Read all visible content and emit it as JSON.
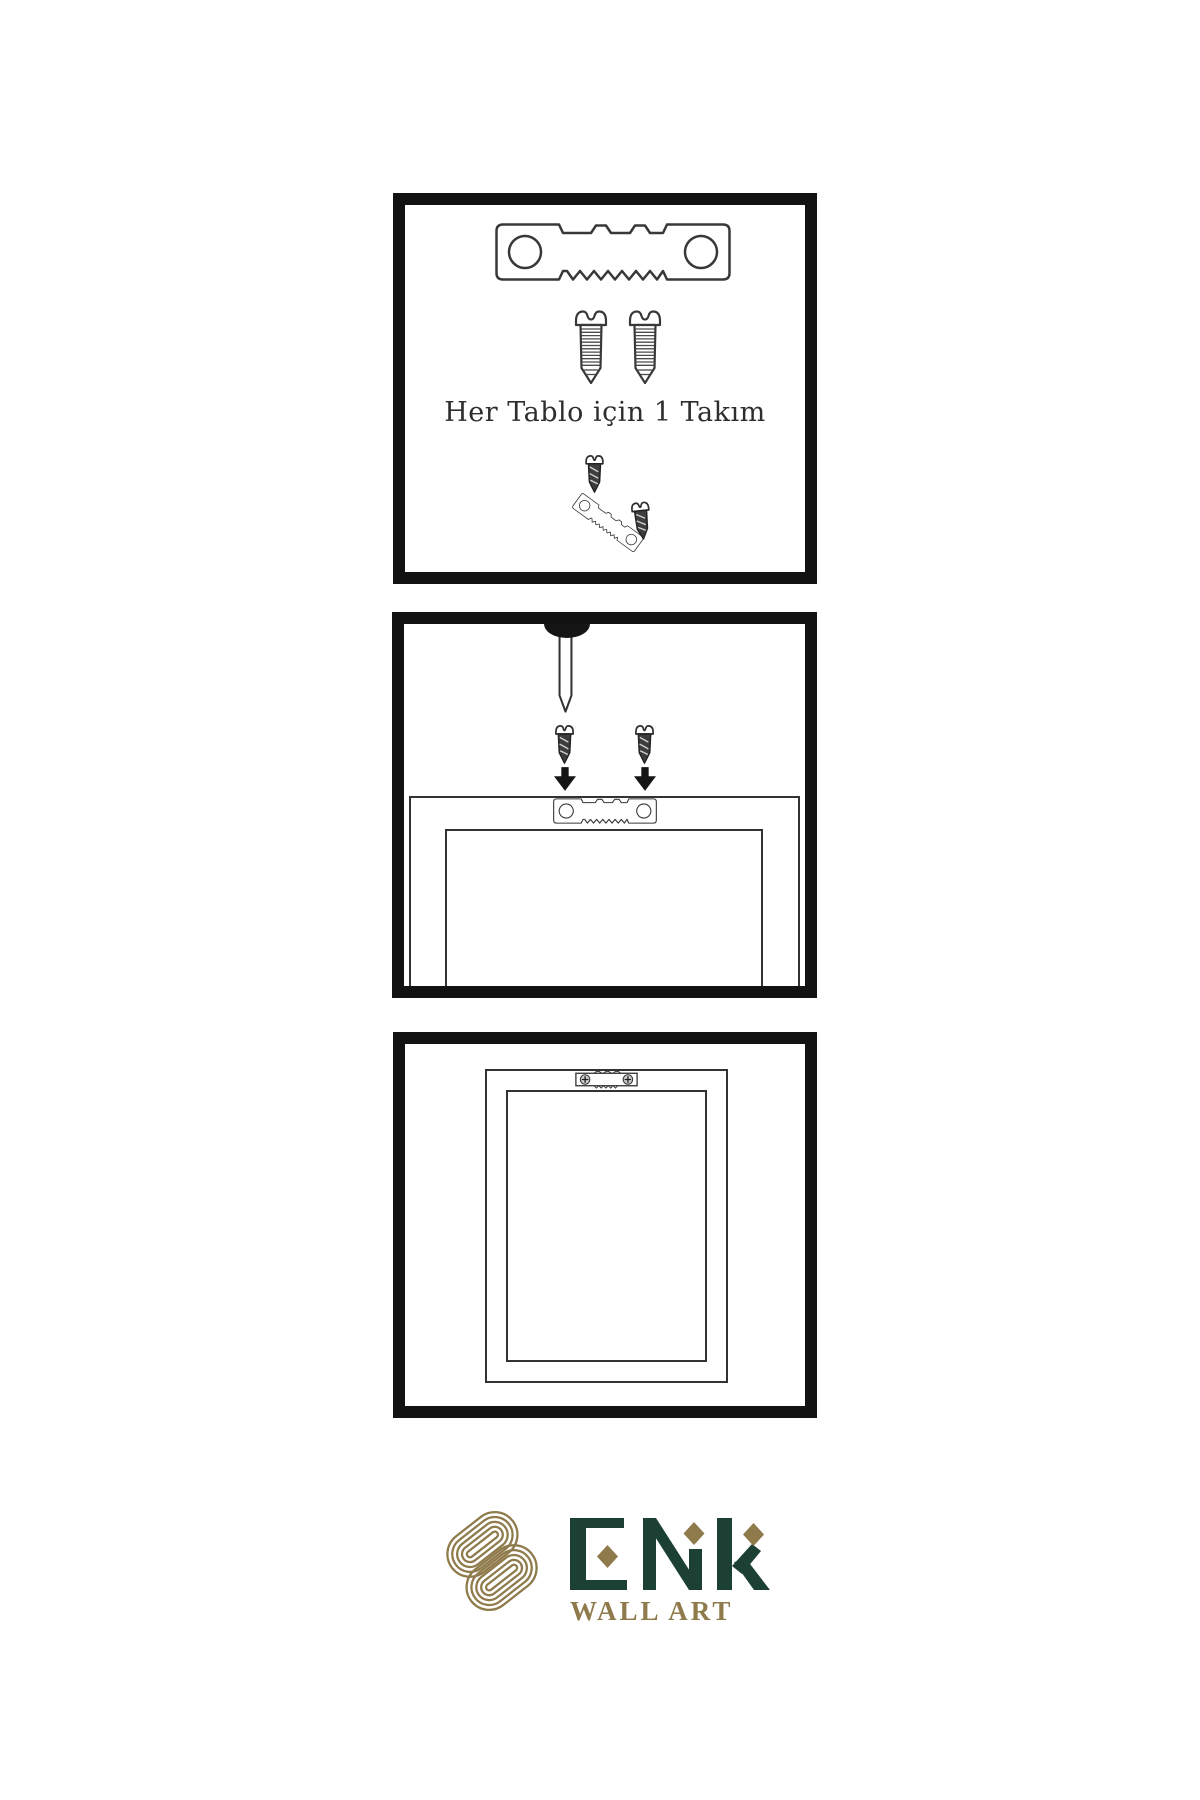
{
  "colors": {
    "background": "#ffffff",
    "panel_border": "#121212",
    "line": "#333333",
    "dark_fill": "#151515",
    "screw_dark": "#3d3d3d",
    "logo_gold": "#8e7a4b",
    "logo_green": "#1d4035",
    "caption_text": "#2e2e2e"
  },
  "step1": {
    "caption": "Her Tablo için 1 Takım",
    "icons": [
      "sawtooth-hanger-icon",
      "screw-icon",
      "screw-icon",
      "screw-dark-icon",
      "tilted-sawtooth-hanger-icon",
      "screw-dark-icon"
    ]
  },
  "step2": {
    "icons": [
      "wall-nail-icon",
      "screw-dark-icon",
      "screw-dark-icon",
      "down-arrow-icon",
      "down-arrow-icon",
      "sawtooth-hanger-icon",
      "frame-back-outline"
    ]
  },
  "step3": {
    "icons": [
      "mounted-sawtooth-hanger-icon",
      "hanging-frame-outline"
    ]
  },
  "logo": {
    "brand": "ENK",
    "subtitle": "WALL ART",
    "emblem": "interlocked-knot-emblem"
  }
}
